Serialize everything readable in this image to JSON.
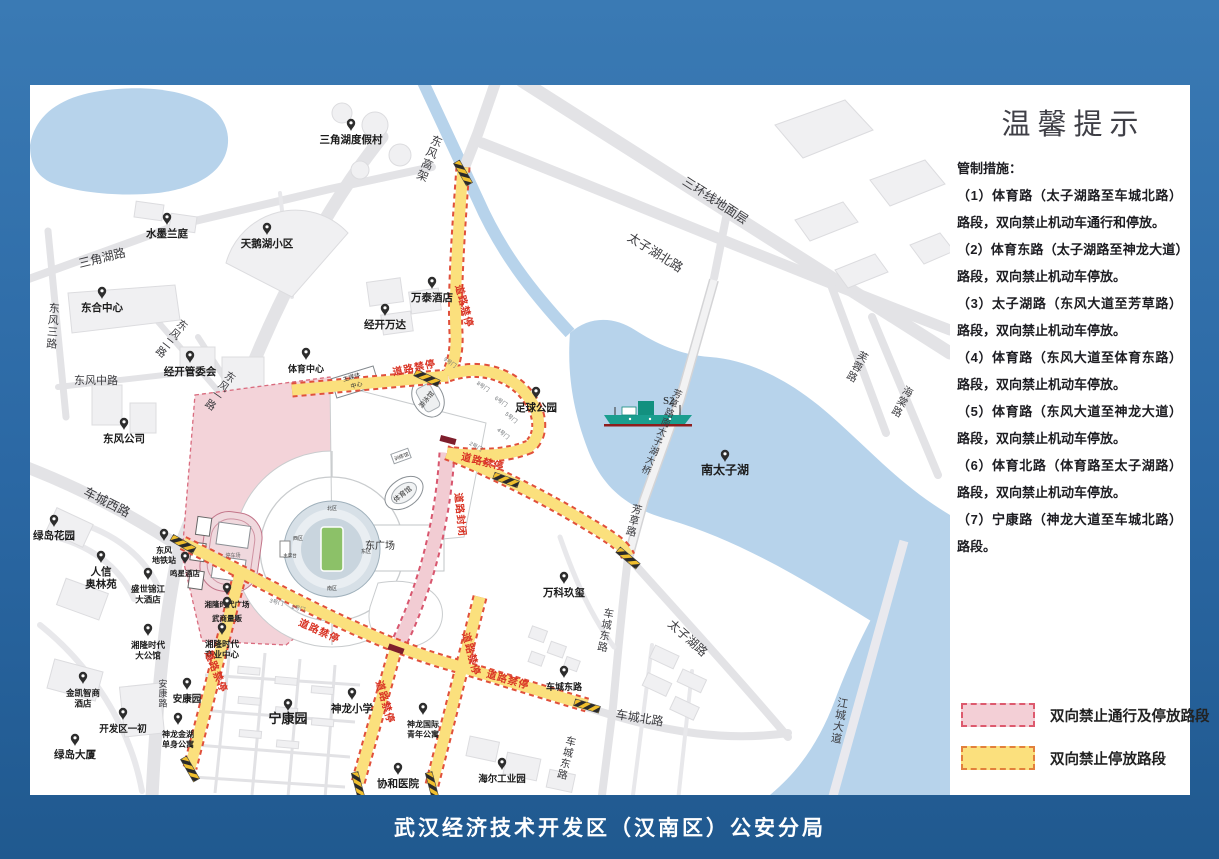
{
  "frame": {
    "footer": "武汉经济技术开发区（汉南区）公安分局"
  },
  "panel": {
    "title": "温馨提示",
    "intro": "管制措施：",
    "measures": [
      "（1）体育路（太子湖路至车城北路）路段，双向禁止机动车通行和停放。",
      "（2）体育东路（太子湖路至神龙大道）路段，双向禁止机动车停放。",
      "（3）太子湖路（东风大道至芳草路）路段，双向禁止机动车停放。",
      "（4）体育路（东风大道至体育东路）路段，双向禁止机动车停放。",
      "（5）体育路（东风大道至神龙大道）路段，双向禁止机动车停放。",
      "（6）体育北路（体育路至太子湖路）路段，双向禁止机动车停放。",
      "（7）宁康路（神龙大道至车城北路）路段。"
    ],
    "legend": [
      {
        "label": "双向禁止通行及停放路段",
        "fill": "#f3cfd6",
        "border": "#dd5a6e"
      },
      {
        "label": "双向禁止停放路段",
        "fill": "#fbe07d",
        "border": "#e2803c"
      }
    ]
  },
  "map": {
    "ship_label": "S2",
    "colors": {
      "water": "#b7d3eb",
      "no_parking_fill": "#fbe07d",
      "no_parking_border": "#e0503c",
      "closed_fill": "#f2ccd3",
      "closed_border": "#d8566e",
      "control_text": "#d93425"
    },
    "pois": [
      {
        "t": "三角湖度假村",
        "x": 321,
        "y": 58
      },
      {
        "t": "水墨兰庭",
        "x": 137,
        "y": 152
      },
      {
        "t": "天鹅湖小区",
        "x": 237,
        "y": 162
      },
      {
        "t": "东合中心",
        "x": 72,
        "y": 226
      },
      {
        "t": "经开管委会",
        "x": 160,
        "y": 290
      },
      {
        "t": "东风公司",
        "x": 94,
        "y": 357
      },
      {
        "t": "万泰酒店",
        "x": 402,
        "y": 216
      },
      {
        "t": "经开万达",
        "x": 355,
        "y": 243
      },
      {
        "t": "体育中心",
        "x": 276,
        "y": 287,
        "s": 9
      },
      {
        "t": "足球公园",
        "x": 506,
        "y": 326
      },
      {
        "t": "南太子湖",
        "x": 695,
        "y": 389,
        "s": 12
      },
      {
        "t": "万科玖玺",
        "x": 534,
        "y": 511
      },
      {
        "t": "绿岛花园",
        "x": 24,
        "y": 454
      },
      {
        "t": "人信|奥林苑",
        "x": 71,
        "y": 490
      },
      {
        "t": "鸣星酒店",
        "x": 155,
        "y": 491,
        "s": 7.5
      },
      {
        "t": "盛世锦江|大酒店",
        "x": 118,
        "y": 507,
        "s": 8.5
      },
      {
        "t": "湘隆时代广场",
        "x": 197,
        "y": 522,
        "s": 7.5
      },
      {
        "t": "武商量贩",
        "x": 197,
        "y": 536,
        "s": 7.5
      },
      {
        "t": "东风|地铁站",
        "x": 134,
        "y": 468,
        "s": 8
      },
      {
        "t": "湘隆时代|大公馆",
        "x": 118,
        "y": 563,
        "s": 8.5
      },
      {
        "t": "湘隆时代|商业中心",
        "x": 192,
        "y": 562,
        "s": 8.5
      },
      {
        "t": "金凯智商|酒店",
        "x": 53,
        "y": 611,
        "s": 8.5
      },
      {
        "t": "安康园",
        "x": 157,
        "y": 617,
        "s": 9.5
      },
      {
        "t": "开发区一初",
        "x": 93,
        "y": 647,
        "s": 9.5
      },
      {
        "t": "神龙金湖|单身公寓",
        "x": 148,
        "y": 652,
        "s": 8
      },
      {
        "t": "绿岛大厦",
        "x": 45,
        "y": 673
      },
      {
        "t": "宁康园",
        "x": 258,
        "y": 638,
        "s": 13
      },
      {
        "t": "神龙小学",
        "x": 322,
        "y": 627
      },
      {
        "t": "神龙国际|青年公寓",
        "x": 393,
        "y": 642,
        "s": 8
      },
      {
        "t": "协和医院",
        "x": 368,
        "y": 702
      },
      {
        "t": "海尔工业园",
        "x": 472,
        "y": 697,
        "s": 9.5
      },
      {
        "t": "车城东路",
        "x": 534,
        "y": 605,
        "s": 9
      }
    ],
    "road_labels": [
      {
        "t": "三角湖路",
        "x": 73,
        "y": 177,
        "r": -14,
        "s": 12
      },
      {
        "t": "东风三路",
        "x": 24,
        "y": 227,
        "v": 1,
        "r": 4,
        "s": 11
      },
      {
        "t": "东风二路",
        "x": 150,
        "y": 243,
        "v": 1,
        "r": 38,
        "s": 10.5
      },
      {
        "t": "东风一路",
        "x": 198,
        "y": 295,
        "v": 1,
        "r": 35,
        "s": 10.5
      },
      {
        "t": "东风中路",
        "x": 66,
        "y": 299,
        "s": 11
      },
      {
        "t": "车城西路",
        "x": 75,
        "y": 421,
        "r": 27,
        "s": 12.5
      },
      {
        "t": "东风高架",
        "x": 405,
        "y": 60,
        "v": 1,
        "r": 22,
        "s": 11.5
      },
      {
        "t": "三环线地面层",
        "x": 683,
        "y": 119,
        "r": 33,
        "s": 12.5
      },
      {
        "t": "太子湖北路",
        "x": 623,
        "y": 171,
        "r": 32,
        "s": 12.5
      },
      {
        "t": "芙蓉路",
        "x": 831,
        "y": 275,
        "v": 1,
        "r": 28,
        "s": 10.5
      },
      {
        "t": "海棠路",
        "x": 876,
        "y": 310,
        "v": 1,
        "r": 28,
        "s": 10.5
      },
      {
        "t": "芳草路南太子湖大桥",
        "x": 646,
        "y": 312,
        "v": 1,
        "r": 22,
        "s": 9.5
      },
      {
        "t": "芳草路",
        "x": 606,
        "y": 428,
        "v": 1,
        "r": 14,
        "s": 10.5
      },
      {
        "t": "车城东路",
        "x": 578,
        "y": 532,
        "v": 1,
        "r": 10,
        "s": 10.5
      },
      {
        "t": "车城东路",
        "x": 540,
        "y": 660,
        "v": 1,
        "r": 14,
        "s": 10.5
      },
      {
        "t": "太子湖路",
        "x": 655,
        "y": 556,
        "r": 42,
        "s": 12
      },
      {
        "t": "车城北路",
        "x": 609,
        "y": 637,
        "r": 9,
        "s": 12
      },
      {
        "t": "江城大道",
        "x": 812,
        "y": 622,
        "v": 1,
        "r": 10,
        "s": 11
      },
      {
        "t": "安康路",
        "x": 133,
        "y": 602,
        "v": 1,
        "r": 0,
        "s": 9
      }
    ],
    "control_labels": [
      {
        "t": "道路禁停",
        "x": 431,
        "y": 222,
        "r": 75
      },
      {
        "t": "道路禁停",
        "x": 385,
        "y": 286,
        "r": -12
      },
      {
        "t": "道路禁停",
        "x": 452,
        "y": 380,
        "r": 14
      },
      {
        "t": "道路禁停",
        "x": 288,
        "y": 549,
        "r": 24
      },
      {
        "t": "道路禁停",
        "x": 477,
        "y": 598,
        "r": 16
      },
      {
        "t": "道路禁停",
        "x": 352,
        "y": 618,
        "r": 74
      },
      {
        "t": "道路禁停",
        "x": 438,
        "y": 570,
        "r": 75
      },
      {
        "t": "道路禁停",
        "x": 183,
        "y": 588,
        "r": 68
      },
      {
        "t": "道路封闭",
        "x": 427,
        "y": 430,
        "r": 84
      }
    ],
    "gate_labels": [
      {
        "t": "9号门",
        "x": 419,
        "y": 279,
        "r": 35
      },
      {
        "t": "8号门",
        "x": 452,
        "y": 303,
        "r": 35
      },
      {
        "t": "6号门",
        "x": 470,
        "y": 318,
        "r": 35
      },
      {
        "t": "5号门",
        "x": 480,
        "y": 334,
        "r": 40
      },
      {
        "t": "4号门",
        "x": 472,
        "y": 350,
        "r": 40
      },
      {
        "t": "2号门",
        "x": 445,
        "y": 363,
        "r": 30
      },
      {
        "t": "3号门",
        "x": 246,
        "y": 519,
        "r": 15
      },
      {
        "t": "2号门",
        "x": 268,
        "y": 525,
        "r": 15
      }
    ],
    "site_labels": [
      {
        "t": "北区",
        "x": 302,
        "y": 425,
        "s": 5
      },
      {
        "t": "西区",
        "x": 268,
        "y": 455,
        "s": 5
      },
      {
        "t": "主席台",
        "x": 260,
        "y": 472,
        "s": 4.5
      },
      {
        "t": "东区",
        "x": 336,
        "y": 468,
        "s": 5
      },
      {
        "t": "南区",
        "x": 302,
        "y": 505,
        "s": 5
      },
      {
        "t": "停车场",
        "x": 203,
        "y": 472,
        "s": 5,
        "c": "#666"
      },
      {
        "t": "东广场",
        "x": 350,
        "y": 464,
        "s": 10
      },
      {
        "t": "体育馆",
        "x": 374,
        "y": 411,
        "s": 7,
        "r": -38
      },
      {
        "t": "游泳馆",
        "x": 398,
        "y": 316,
        "s": 6.5,
        "r": -50
      },
      {
        "t": "训练馆",
        "x": 372,
        "y": 373,
        "s": 5,
        "r": -20
      },
      {
        "t": "主媒体",
        "x": 322,
        "y": 294,
        "s": 6,
        "r": -16
      },
      {
        "t": "中心",
        "x": 327,
        "y": 302,
        "s": 6,
        "r": -16
      }
    ]
  }
}
